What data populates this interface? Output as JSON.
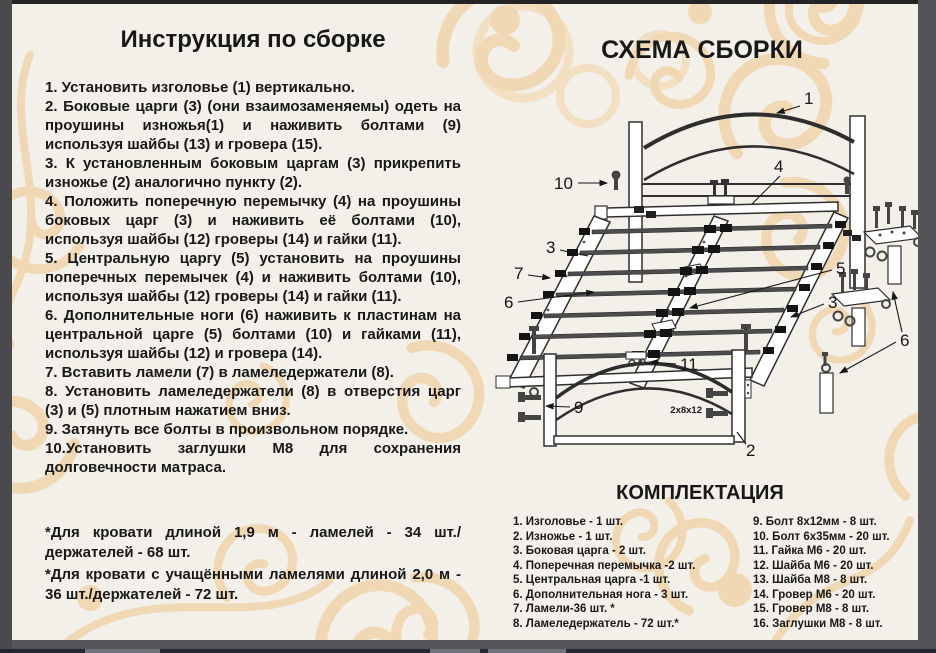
{
  "page": {
    "background_color": "#f3efe9",
    "ornament_color": "#f0d8b5",
    "frame_color": "#4a4a4e",
    "taskbar_color": "#232830"
  },
  "instructions": {
    "title": "Инструкция по сборке",
    "steps": [
      "1. Установить изголовье (1) вертикально.",
      "2. Боковые царги (3) (они взаимозаменяемы) одеть на проушины изножья(1) и наживить болтами (9) используя шайбы (13) и гровера (15).",
      "3. К установленным боковым царгам (3) прикрепить изножье (2) аналогично пункту (2).",
      "4. Положить поперечную перемычку (4) на проушины боковых царг (3) и наживить её болтами (10), используя шайбы (12) гроверы (14) и гайки (11).",
      "5. Центральную царгу (5) установить на проушины поперечных перемычек (4) и наживить болтами (10), используя шайбы (12) гроверы (14) и гайки (11).",
      "6. Дополнительные ноги (6) наживить к пластинам на центральной царге (5) болтами (10) и гайками (11), используя шайбы (12) и гровера (14).",
      "7. Вставить ламели (7) в ламеледержатели (8).",
      "8. Установить ламеледержатели (8) в отверстия царг (3) и (5) плотным нажатием вниз.",
      "9. Затянуть все болты в произвольном порядке.",
      "10.Установить заглушки М8 для сохранения долговечности матраса."
    ],
    "notes": [
      "*Для кровати длиной 1,9 м - ламелей - 34 шт./держателей - 68 шт.",
      "*Для кровати с учащёнными ламелями длиной 2,0 м - 36 шт./держателей - 72 шт."
    ]
  },
  "diagram": {
    "title": "СХЕМА СБОРКИ",
    "callouts": {
      "c1": "1",
      "c2": "2",
      "c3_left": "3",
      "c3_right": "3",
      "c4": "4",
      "c5": "5",
      "c6_left": "6",
      "c6_right": "6",
      "c7": "7",
      "c9": "9",
      "c10": "10",
      "c11": "11"
    },
    "bolt_note": "2x8x12"
  },
  "parts": {
    "title": "КОМПЛЕКТАЦИЯ",
    "items_left": [
      "1. Изголовье - 1 шт.",
      "2. Изножье - 1 шт.",
      "3. Боковая царга - 2 шт.",
      "4. Поперечная перемычка -2 шт.",
      "5. Центральная царга -1 шт.",
      "6. Дополнительная нога - 3 шт.",
      "7. Ламели-36 шт. *",
      "8. Ламеледержатель - 72 шт.*"
    ],
    "items_right": [
      "9. Болт 8x12мм - 8 шт.",
      "10. Болт 6x35мм - 20 шт.",
      "11. Гайка М6 - 20 шт.",
      "12. Шайба М6 - 20 шт.",
      "13. Шайба М8 - 8 шт.",
      "14. Гровер М6 - 20 шт.",
      "15. Гровер М8 - 8 шт.",
      "16. Заглушки М8 - 8 шт."
    ]
  }
}
